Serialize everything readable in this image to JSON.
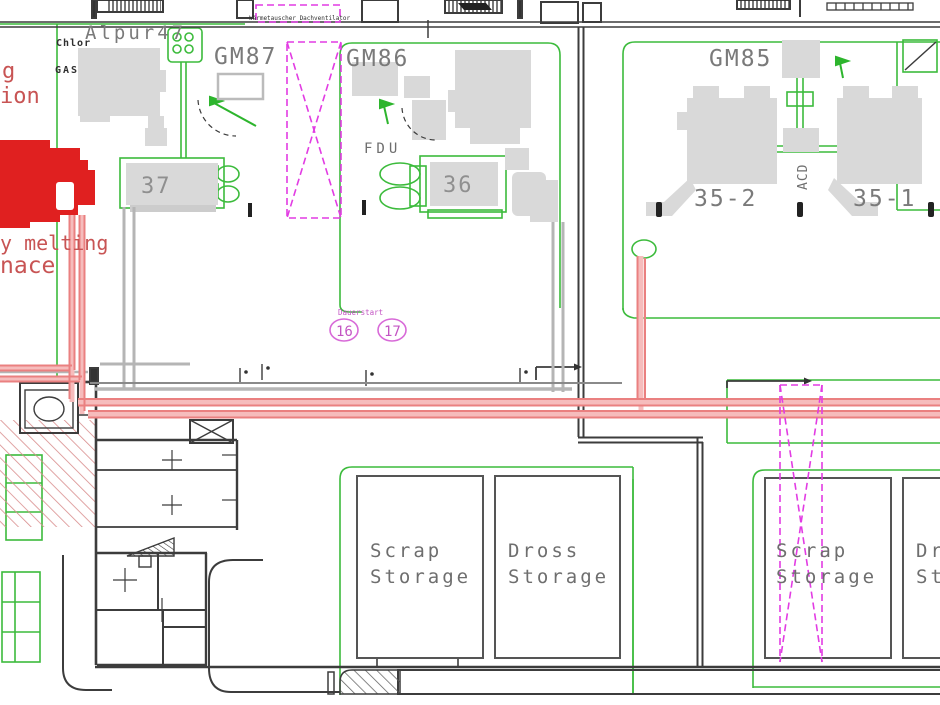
{
  "title_labels": {
    "alpur": "Alpur47",
    "gm87": "GM87",
    "gm86": "GM86",
    "gm85": "GM85"
  },
  "equipment_labels": {
    "chlor": "Chlor",
    "gas": "GAS",
    "fdu": "FDU",
    "station_37": "37",
    "station_36": "36",
    "furnace_35_2": "35-2",
    "furnace_35_1": "35-1",
    "acd": "ACD"
  },
  "storage_labels": {
    "scrap_line1": "Scrap",
    "scrap_line2": "Storage",
    "dross_line1": "Dross",
    "dross_line2": "Storage"
  },
  "red_labels": {
    "cut_line1": "g",
    "cut_line2": "ion",
    "cut_line3": "y melting",
    "cut_line4": "nace"
  },
  "tags": {
    "tag16": "16",
    "tag17": "17",
    "tag_note": "Dauerstart",
    "roof_note": "Wärmetauscher Dachventilator"
  },
  "colors": {
    "zone_green": "#3cbb3c",
    "gray_fill": "#d9d9d9",
    "wall": "#3c3c3c",
    "red": "#e02020",
    "red_text": "#c85454",
    "pipe_light": "#f6bcbc",
    "pipe_dark": "#ea8080",
    "pipe_gray": "#b5b5b5",
    "magenta": "#e23ce3",
    "magenta_text": "#c355c3",
    "label_gray": "#7a7a7a",
    "dark_text": "#2f2f2f"
  }
}
